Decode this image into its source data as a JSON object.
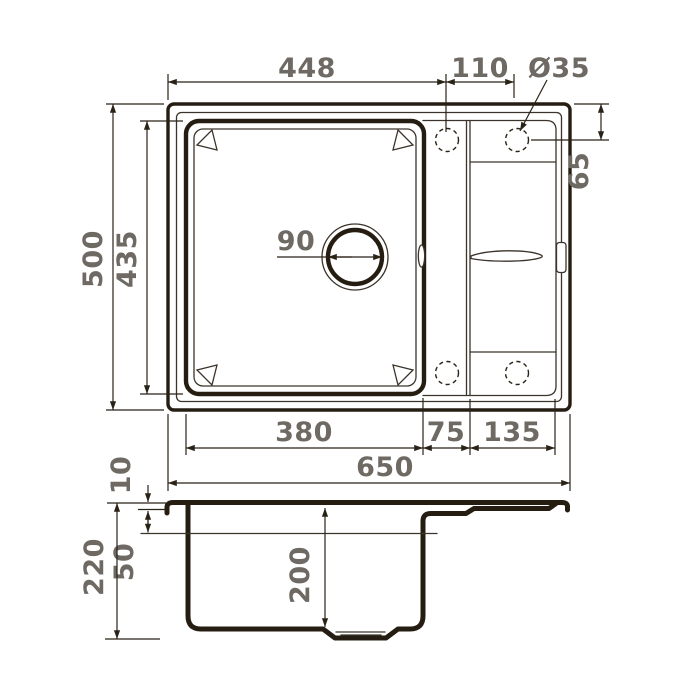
{
  "drawing": {
    "type": "technical-drawing",
    "subject": "kitchen sink with drainboard - top view and cross-section",
    "colors": {
      "line": "#261d12",
      "dim_text": "#6e6963",
      "background": "#ffffff"
    },
    "top_view_dims": {
      "left_to_hole": "448",
      "hole_spacing": "110",
      "hole_diameter": "Ø35",
      "hole_offset": "65",
      "overall_depth": "500",
      "bowl_depth": "435",
      "drain_diameter": "90",
      "bowl_width": "380",
      "mid_section": "75",
      "drainboard": "135",
      "overall_width": "650"
    },
    "side_view_dims": {
      "rim_height": "10",
      "total_depth": "220",
      "ledge_depth": "50",
      "bowl_depth": "200"
    }
  }
}
